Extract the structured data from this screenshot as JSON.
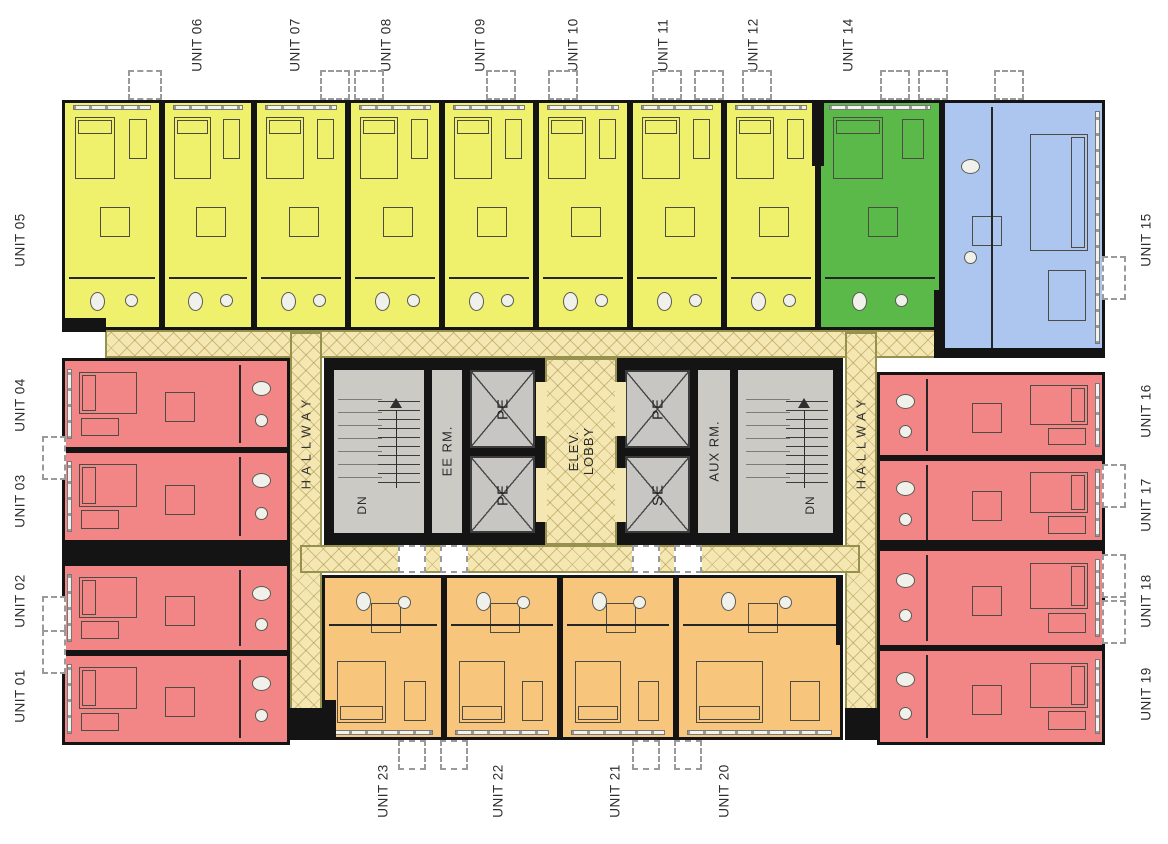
{
  "colors": {
    "yellow": "#eff06c",
    "red": "#f28585",
    "orange": "#f8c57d",
    "green": "#5bb94a",
    "blue": "#adc6f0",
    "hallway": "#f4e7b2",
    "core_room": "#cbcac5",
    "wall": "#141414"
  },
  "units": {
    "u01": {
      "label": "UNIT 01",
      "color": "red"
    },
    "u02": {
      "label": "UNIT 02",
      "color": "red"
    },
    "u03": {
      "label": "UNIT 03",
      "color": "red"
    },
    "u04": {
      "label": "UNIT 04",
      "color": "red"
    },
    "u05": {
      "label": "UNIT 05",
      "color": "yellow"
    },
    "u06": {
      "label": "UNIT 06",
      "color": "yellow"
    },
    "u07": {
      "label": "UNIT 07",
      "color": "yellow"
    },
    "u08": {
      "label": "UNIT 08",
      "color": "yellow"
    },
    "u09": {
      "label": "UNIT 09",
      "color": "yellow"
    },
    "u10": {
      "label": "UNIT 10",
      "color": "yellow"
    },
    "u11": {
      "label": "UNIT 11",
      "color": "yellow"
    },
    "u12": {
      "label": "UNIT 12",
      "color": "yellow"
    },
    "u14": {
      "label": "UNIT 14",
      "color": "green"
    },
    "u15": {
      "label": "UNIT 15",
      "color": "blue"
    },
    "u16": {
      "label": "UNIT 16",
      "color": "red"
    },
    "u17": {
      "label": "UNIT 17",
      "color": "red"
    },
    "u18": {
      "label": "UNIT 18",
      "color": "red"
    },
    "u19": {
      "label": "UNIT 19",
      "color": "red"
    },
    "u20": {
      "label": "UNIT 20",
      "color": "orange"
    },
    "u21": {
      "label": "UNIT 21",
      "color": "orange"
    },
    "u22": {
      "label": "UNIT 22",
      "color": "orange"
    },
    "u23": {
      "label": "UNIT 23",
      "color": "orange"
    }
  },
  "core": {
    "hallway_left": "HALLWAY",
    "hallway_right": "HALLWAY",
    "elev_lobby_line1": "ELEV.",
    "elev_lobby_line2": "LOBBY",
    "ee_room": "EE RM.",
    "aux_room": "AUX RM.",
    "dn_left": "DN",
    "dn_right": "DN",
    "elevators": [
      {
        "label": "PE"
      },
      {
        "label": "PE"
      },
      {
        "label": "PE"
      },
      {
        "label": "SE"
      }
    ]
  }
}
